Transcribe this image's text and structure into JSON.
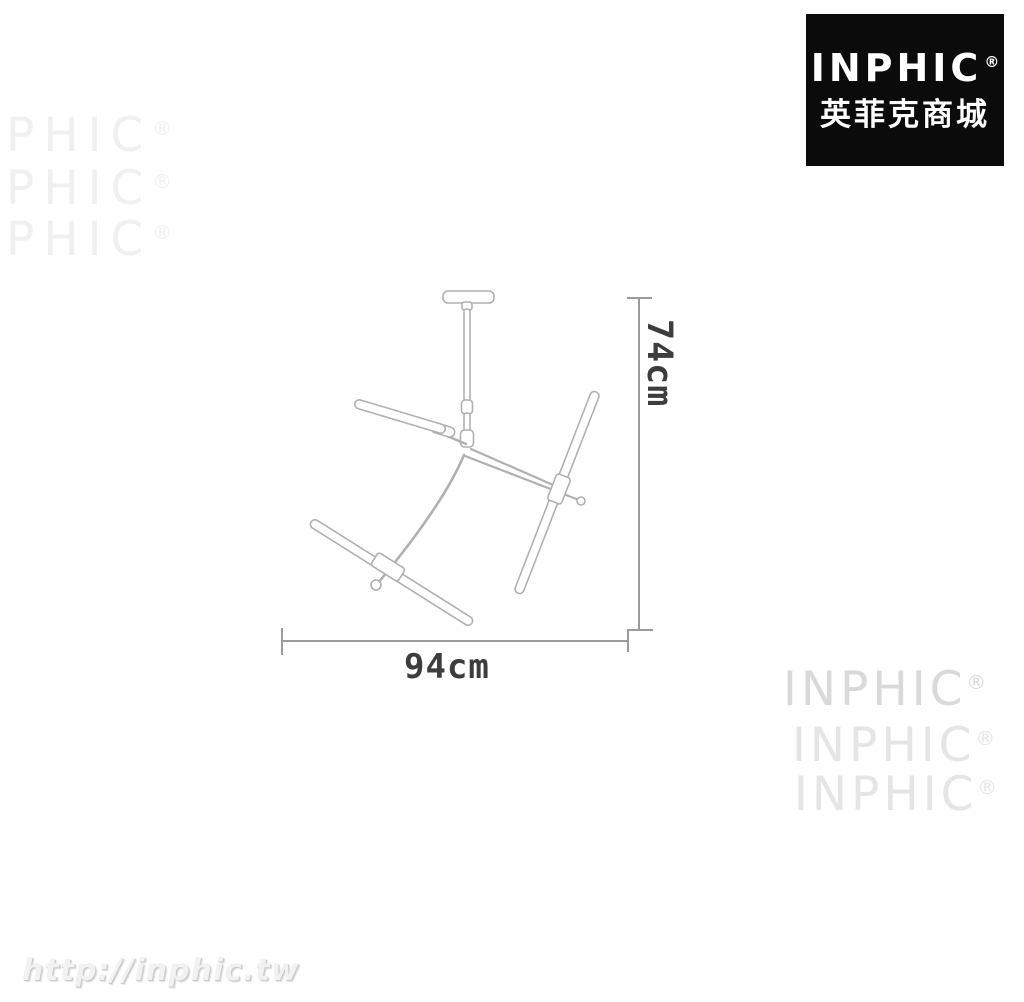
{
  "brand_badge": {
    "name": "INPHIC",
    "reg": "®",
    "subtitle": "英菲克商城",
    "bg_color": "#0b0b0b",
    "text_color": "#ffffff"
  },
  "diagram": {
    "kind": "product dimension line drawing",
    "product": "sputnik tube chandelier",
    "height_label": "74cm",
    "width_label": "94cm",
    "fixture_line_color": "#b0b0b0",
    "dimension_line_color": "#9b9b9b",
    "label_color": "#3d3d3d"
  },
  "watermarks": {
    "top_left": {
      "label": "PHIC",
      "reg": "®",
      "color": "#f0f0f0"
    },
    "bottom_right": {
      "label": "INPHIC",
      "reg": "®",
      "row1_color": "#d9d9d9",
      "row_color": "#e5e5e5"
    },
    "url": {
      "text": "http://inphic.tw",
      "color": "#f2f2f2"
    }
  }
}
